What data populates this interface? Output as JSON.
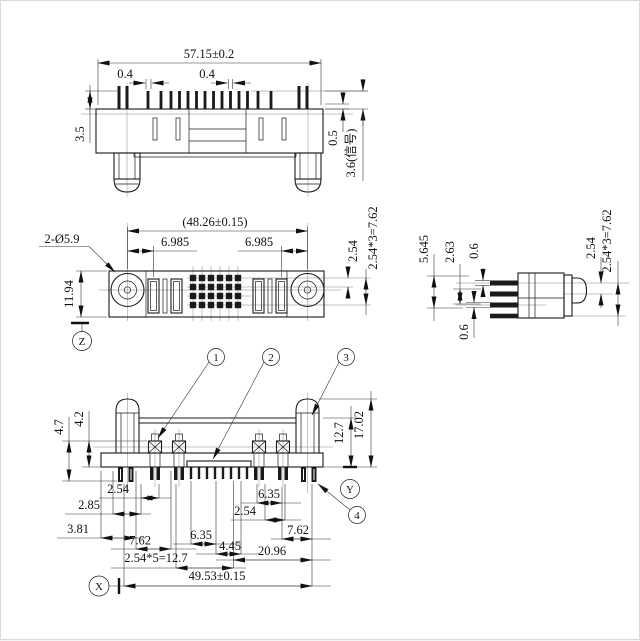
{
  "top": {
    "overall": "57.15±0.2",
    "pin_w_left": "0.4",
    "pin_w_center": "0.4",
    "pin_height": "3.5",
    "gap": "0.5",
    "signal_len": "3.6(信号)"
  },
  "front": {
    "span": "(48.26±0.15)",
    "offset_left": "6.985",
    "offset_right": "6.985",
    "pitch": "2.54",
    "row_span": "2.54*3=7.62",
    "height": "11.94",
    "holes": "2-Ø5.9",
    "datum": "Z"
  },
  "side": {
    "total": "5.645",
    "mid": "2.63",
    "pin_thk_top": "0.6",
    "pin_thk_bottom": "0.6",
    "pitch": "2.54",
    "row_span": "2.54*3=7.62"
  },
  "bottom": {
    "peg_len": "4.7",
    "term_len": "4.2",
    "body_h": "12.7",
    "total_h": "17.02",
    "p1": "2.54",
    "p2": "2.85",
    "p3": "3.81",
    "p4": "6.35",
    "p5": "7.62",
    "p6": "4.45",
    "p7": "2.54*5=12.7",
    "p8": "6.35",
    "p9": "2.54",
    "p10": "7.62",
    "p11": "20.96",
    "overall": "49.53±0.15",
    "datum_x": "X",
    "datum_y": "Y"
  },
  "callouts": {
    "c1": "1",
    "c2": "2",
    "c3": "3",
    "c4": "4"
  },
  "colors": {
    "line": "#1a1a1a",
    "centerline": "#ababab",
    "background": "#ffffff"
  }
}
